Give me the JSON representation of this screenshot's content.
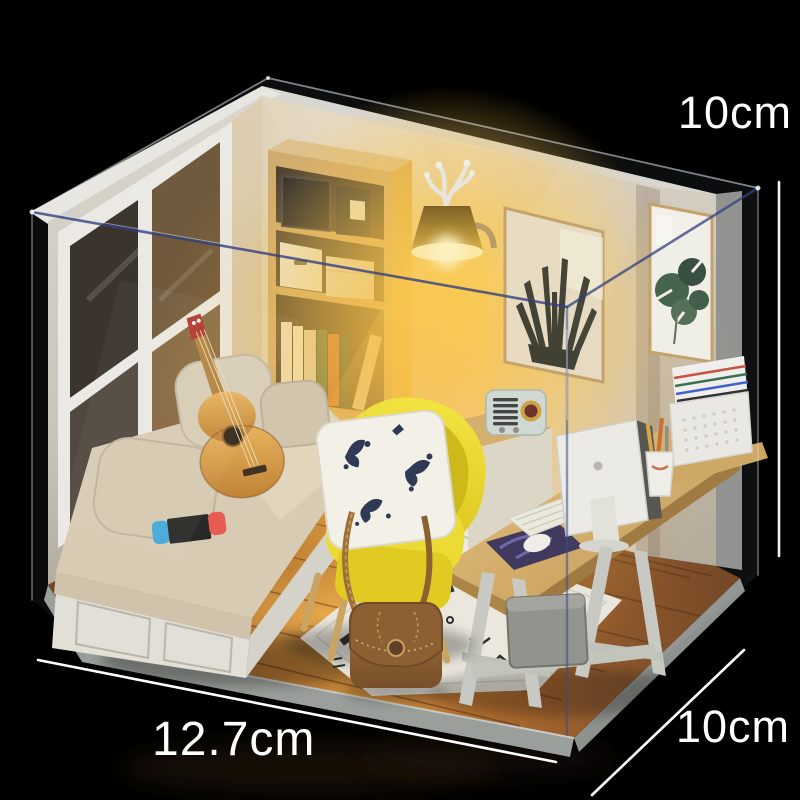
{
  "title": "DIY miniature dollhouse room kit with acrylic dust cover",
  "dimensions": {
    "height": {
      "label": "10cm"
    },
    "width": {
      "label": "12.7cm"
    },
    "depth": {
      "label": "10cm"
    }
  },
  "scene": {
    "objects": [
      "window",
      "window-seat-daybed",
      "boucle-pillows",
      "acoustic-guitar",
      "game-console",
      "yellow-armchair",
      "botanical-throw-pillow",
      "leather-handbag",
      "patterned-rug",
      "wooden-desk",
      "computer-monitor",
      "keyboard",
      "mousepad",
      "pen-cup",
      "file-box",
      "retro-radio",
      "side-cabinet",
      "bookshelf",
      "books",
      "storage-boxes",
      "wall-lamp",
      "antler-lamp-decor",
      "sansevieria-art-frame",
      "monstera-art-frame",
      "wood-plank-floor",
      "grey-storage-box",
      "acrylic-dust-cover"
    ]
  },
  "colors": {
    "background": "#000000",
    "label_text": "#ffffff",
    "lamp_glow": "#ffd44e",
    "chair_yellow": "#ecd51a",
    "wood": "#d2a765",
    "floor_wood": "#a4611f",
    "acrylic_edge": "#3c4c8c",
    "wall_warm": "#e9ddc8"
  }
}
